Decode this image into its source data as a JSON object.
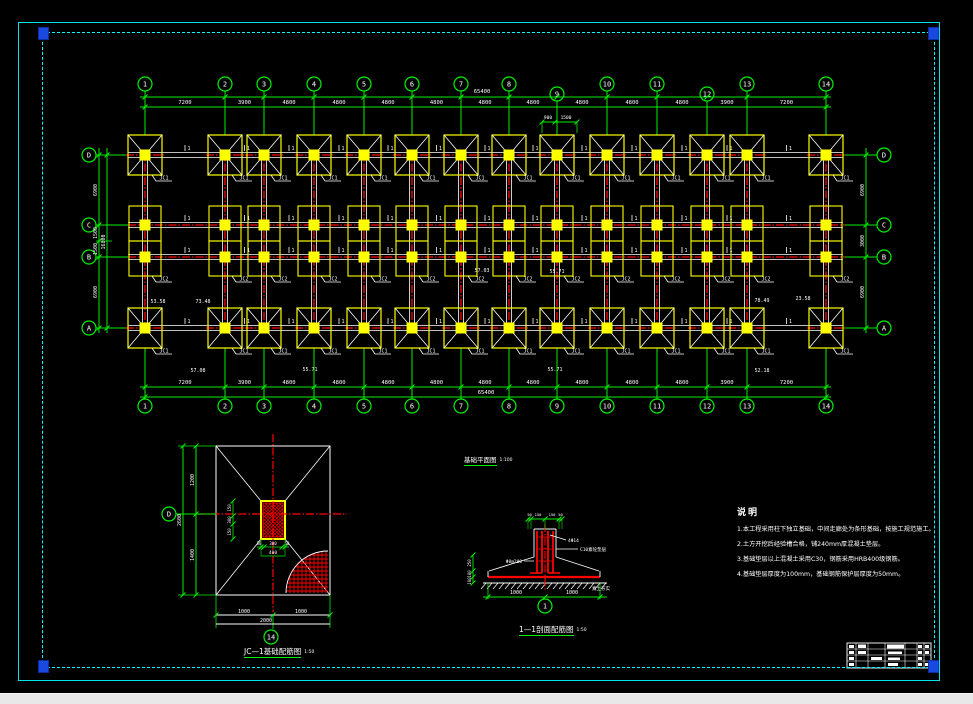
{
  "colors": {
    "green": "#00f000",
    "red": "#ff0000",
    "yellow": "#ffff00",
    "white": "#ffffff",
    "cyan": "#00ffff",
    "grip": "#1a49e2",
    "taskbar": "#e8e8e8"
  },
  "plan": {
    "title": "基础平面图",
    "scale": "1:100",
    "col_grids": [
      "1",
      "2",
      "3",
      "4",
      "5",
      "6",
      "7",
      "8",
      "9",
      "10",
      "11",
      "12",
      "13",
      "14"
    ],
    "row_grids": [
      "D",
      "C",
      "B",
      "A"
    ],
    "bay_dims": [
      "7200",
      "3900",
      "4800",
      "4800",
      "4800",
      "4800",
      "4800",
      "4800",
      "4800",
      "4800",
      "4800",
      "3900",
      "7200"
    ],
    "total_dim": "65400",
    "left_dims": [
      "6900",
      "1500",
      "1500",
      "6900"
    ],
    "left_total": "16800",
    "right_dims": [
      "6900",
      "3000",
      "6900"
    ],
    "offset_dims": [
      "900",
      "1500"
    ],
    "footing_label_main": "JC1",
    "footing_label_strip": "JC2",
    "section_mark": "1",
    "spot_labels": [
      {
        "text": "53.58",
        "x": 158,
        "y": 303
      },
      {
        "text": "73.48",
        "x": 203,
        "y": 303
      },
      {
        "text": "57.03",
        "x": 482,
        "y": 272
      },
      {
        "text": "55.71",
        "x": 557,
        "y": 273
      },
      {
        "text": "78.49",
        "x": 762,
        "y": 302
      },
      {
        "text": "23.58",
        "x": 803,
        "y": 300
      },
      {
        "text": "57.08",
        "x": 198,
        "y": 372
      },
      {
        "text": "55.71",
        "x": 310,
        "y": 371
      },
      {
        "text": "55.71",
        "x": 555,
        "y": 371
      },
      {
        "text": "52.18",
        "x": 762,
        "y": 372
      }
    ]
  },
  "detail": {
    "title": "JC—1基础配筋图",
    "scale": "1:50",
    "bubble_left": "D",
    "bubble_bottom": "14",
    "left_seg_dims": [
      "1200",
      "1400"
    ],
    "left_total": "2600",
    "bottom_seg_dims": [
      "1000",
      "1000"
    ],
    "bottom_total": "2000",
    "ped_width_dims": [
      "50",
      "300",
      "50"
    ],
    "ped_width_total": "400",
    "ped_height_dims": [
      "150",
      "300",
      "150"
    ]
  },
  "section": {
    "title": "1—1剖面配筋图",
    "scale": "1:50",
    "bubble": "1",
    "top_dims": [
      "50",
      "150",
      "150",
      "50"
    ],
    "left_dims": [
      "250",
      "100",
      "100"
    ],
    "bottom_dims": [
      "1000",
      "1000"
    ],
    "label_bars": "4Φ14",
    "label_stirrups": "Φ8@200",
    "label_bedding": "C10素砼垫层",
    "label_soil": "素土夯实"
  },
  "notes": {
    "heading": "说明",
    "items": [
      "1.本工程采用柱下独立基础，中间走廊处为条形基础，按施工规范施工。",
      "2.土方开挖后经验槽合格，铺240mm厚混凝土垫层。",
      "3.基础垫层以上混凝土采用C30，钢筋采用HRB400级钢筋。",
      "4.基础垫层厚度为100mm，基础钢筋保护层厚度为50mm。"
    ]
  }
}
